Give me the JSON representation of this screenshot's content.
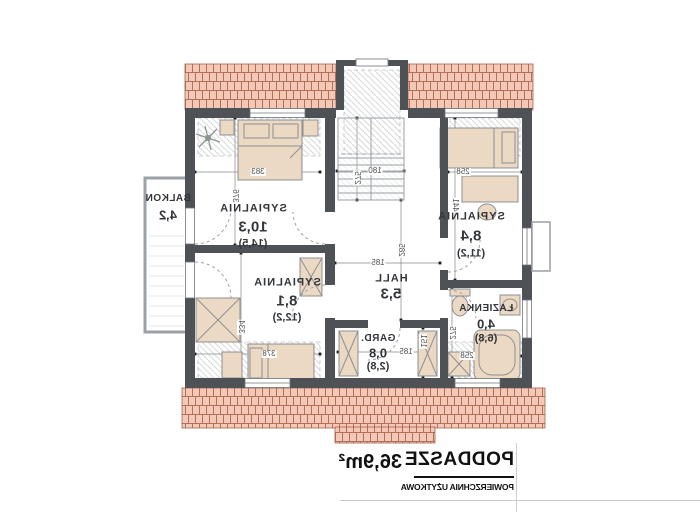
{
  "title_block": {
    "title": "PODDASZE",
    "subtitle": "POWIERZCHNIA UŻYTKOWA",
    "area": "36,9m²"
  },
  "rooms": {
    "bedroom1": {
      "name": "SYPIALNIA",
      "area": "10,3",
      "total": "(14,5)"
    },
    "bedroom2": {
      "name": "SYPIALNIA",
      "area": "8,4",
      "total": "(11,2)"
    },
    "bedroom3": {
      "name": "SYPIALNIA",
      "area": "8,1",
      "total": "(12,2)"
    },
    "hall": {
      "name": "HALL",
      "area": "5,3"
    },
    "wardrobe": {
      "name": "GARD.",
      "area": "0,8",
      "total": "(2,8)"
    },
    "bathroom": {
      "name": "ŁAZIENKA",
      "area": "4,0",
      "total": "(6,8)"
    },
    "balcony": {
      "name": "BALKON",
      "area": "4,2"
    }
  },
  "dims": {
    "bedroom1_w": "383",
    "bedroom1_h": "376",
    "bedroom2_w": "258",
    "bedroom2_h": "441",
    "bedroom3_w": "378",
    "bedroom3_h": "334",
    "hall_w": "185",
    "hall_h": "285",
    "stairs_w": "180",
    "stairs_h": "275",
    "wardrobe_w": "185",
    "wardrobe_h": "151",
    "bathroom_w": "258",
    "bathroom_h": "275"
  },
  "colors": {
    "wall": "#4e5257",
    "roofFill": "#f4c8b6",
    "roofLine": "#b2705a",
    "furniture": "#ecd9c3",
    "furnitureLine": "#8d9093",
    "dimLine": "#85888b",
    "text": "#33363a"
  }
}
